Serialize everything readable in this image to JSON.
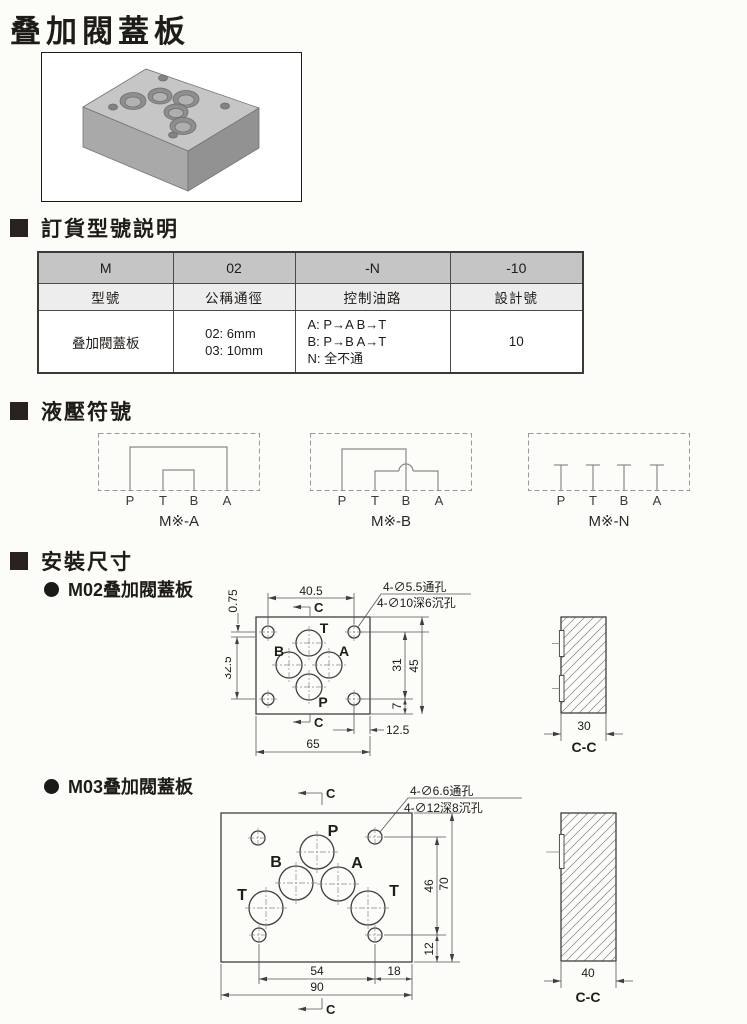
{
  "title": "叠加閥蓋板",
  "sections": {
    "ordering": "訂貨型號説明",
    "symbols": "液壓符號",
    "mounting": "安裝尺寸"
  },
  "order_table": {
    "code": [
      "M",
      "02",
      "-N",
      "-10"
    ],
    "headers": [
      "型號",
      "公稱通徑",
      "控制油路",
      "設計號"
    ],
    "row": {
      "model": "叠加閥蓋板",
      "sizes": [
        "02:  6mm",
        "03:  10mm"
      ],
      "circuits": [
        "A:  P→A    B→T",
        "B:  P→B    A→T",
        "N:  全不通"
      ],
      "design": "10"
    }
  },
  "symbols": {
    "items": [
      {
        "caption": "M※-A",
        "ports": [
          "P",
          "T",
          "B",
          "A"
        ]
      },
      {
        "caption": "M※-B",
        "ports": [
          "P",
          "T",
          "B",
          "A"
        ]
      },
      {
        "caption": "M※-N",
        "ports": [
          "P",
          "T",
          "B",
          "A"
        ]
      }
    ]
  },
  "m02": {
    "label": "M02叠加閥蓋板",
    "leader1": "4-∅5.5通孔",
    "leader2": "4-∅10深6沉孔",
    "section_mark": "C",
    "ports": {
      "t": "T",
      "b": "B",
      "a": "A",
      "p": "P"
    },
    "dims": {
      "top": "40.5",
      "offset": "0.75",
      "left": "32.5",
      "right_inner": "31",
      "right_outer": "45",
      "right_small": "7",
      "corner": "12.5",
      "bottom": "65"
    },
    "cc": {
      "width": "30",
      "caption": "C-C"
    }
  },
  "m03": {
    "label": "M03叠加閥蓋板",
    "leader1": "4-∅6.6通孔",
    "leader2": "4-∅12深8沉孔",
    "section_mark": "C",
    "ports": {
      "p": "P",
      "b": "B",
      "a": "A",
      "t1": "T",
      "t2": "T"
    },
    "dims": {
      "right_inner": "46",
      "right_outer": "70",
      "right_small": "12",
      "bottom_left": "54",
      "bottom_right": "18",
      "bottom": "90"
    },
    "cc": {
      "width": "40",
      "caption": "C-C"
    }
  }
}
